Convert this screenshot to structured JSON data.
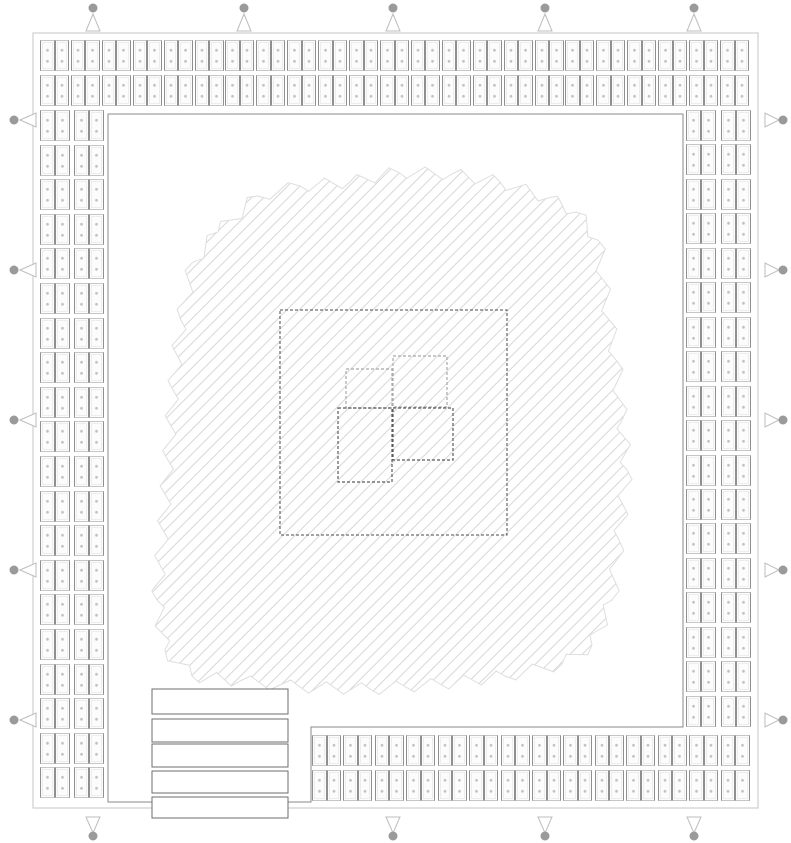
{
  "diagram": {
    "kind": "chip-die-floorplan",
    "canvas": {
      "width": 791,
      "height": 843,
      "background": "#ffffff"
    }
  },
  "colors": {
    "outer_border": "#cfcfcf",
    "core_boundary": "#8a8a8a",
    "pad_fill": "#fcfcfc",
    "pad_side_border": "#8f8f8f",
    "pad_end_border": "#c6c6c6",
    "pad_inner_line": "#ededed",
    "pad_dot": "#c2c2c2",
    "hatch_line": "#d7d7d7",
    "hatch_edge": "#dedede",
    "dashed_core": "#4a4a4a",
    "block_light": "#a8a8a8",
    "block_dark": "#5a5a5a",
    "bar_stroke": "#6e6e6e",
    "bar_fill": "#ffffff",
    "marker_circle": "#9a9a9a",
    "marker_triangle": "#bdbdbd"
  },
  "die": {
    "outer_border": {
      "x": 33,
      "y": 33,
      "w": 725,
      "h": 775
    },
    "core_boundary_points": [
      [
        108,
        114
      ],
      [
        683,
        114
      ],
      [
        683,
        727
      ],
      [
        311,
        727
      ],
      [
        311,
        802
      ],
      [
        108,
        802
      ]
    ]
  },
  "pad_ring": {
    "group": {
      "h_w": 29,
      "h_h": 31,
      "v_w": 30,
      "v_h": 31
    },
    "sides": [
      {
        "name": "top",
        "orientation": "h",
        "count": 23,
        "start": 40,
        "pitch": 30.91,
        "lines": [
          40,
          75
        ]
      },
      {
        "name": "bottom",
        "orientation": "h",
        "count": 14,
        "start": 312,
        "pitch": 31.43,
        "lines": [
          735,
          770
        ]
      },
      {
        "name": "left",
        "orientation": "v",
        "count": 20,
        "start": 110,
        "pitch": 34.6,
        "lines": [
          40,
          74
        ]
      },
      {
        "name": "right",
        "orientation": "v",
        "count": 18,
        "start": 110,
        "pitch": 34.45,
        "lines": [
          686,
          721
        ]
      }
    ]
  },
  "markers": {
    "top_x": [
      93,
      244,
      393,
      545,
      694
    ],
    "bottom_x": [
      93,
      393,
      545,
      694
    ],
    "left_y": [
      120,
      270,
      420,
      570,
      720
    ],
    "right_y": [
      120,
      270,
      420,
      570,
      720
    ]
  },
  "hatch": {
    "spacing": 8.7,
    "angle_deg": -45,
    "blob_outline": [
      [
        218,
        232
      ],
      [
        258,
        196
      ],
      [
        300,
        186
      ],
      [
        350,
        182
      ],
      [
        398,
        172
      ],
      [
        452,
        174
      ],
      [
        500,
        182
      ],
      [
        548,
        198
      ],
      [
        576,
        212
      ],
      [
        598,
        240
      ],
      [
        606,
        300
      ],
      [
        616,
        360
      ],
      [
        622,
        420
      ],
      [
        627,
        470
      ],
      [
        619,
        540
      ],
      [
        612,
        600
      ],
      [
        592,
        645
      ],
      [
        562,
        664
      ],
      [
        505,
        676
      ],
      [
        440,
        684
      ],
      [
        370,
        689
      ],
      [
        300,
        687
      ],
      [
        240,
        681
      ],
      [
        192,
        676
      ],
      [
        165,
        650
      ],
      [
        157,
        600
      ],
      [
        163,
        530
      ],
      [
        168,
        460
      ],
      [
        173,
        390
      ],
      [
        181,
        320
      ],
      [
        193,
        262
      ]
    ],
    "jag_step": 18,
    "jag_amp": 6
  },
  "center": {
    "dashed_square": {
      "x": 280,
      "y": 310,
      "w": 227,
      "h": 225
    },
    "blocks": [
      {
        "x": 346,
        "y": 369,
        "w": 46,
        "h": 39,
        "tone": "light"
      },
      {
        "x": 393,
        "y": 356,
        "w": 54,
        "h": 51,
        "tone": "light"
      },
      {
        "x": 338,
        "y": 408,
        "w": 54,
        "h": 74,
        "tone": "dark"
      },
      {
        "x": 393,
        "y": 408,
        "w": 60,
        "h": 52,
        "tone": "dark"
      }
    ]
  },
  "bars": {
    "x": 152,
    "w": 136,
    "items": [
      {
        "y": 689,
        "h": 25
      },
      {
        "y": 719,
        "h": 23
      },
      {
        "y": 744,
        "h": 23
      },
      {
        "y": 771,
        "h": 22
      },
      {
        "y": 797,
        "h": 21
      }
    ]
  }
}
